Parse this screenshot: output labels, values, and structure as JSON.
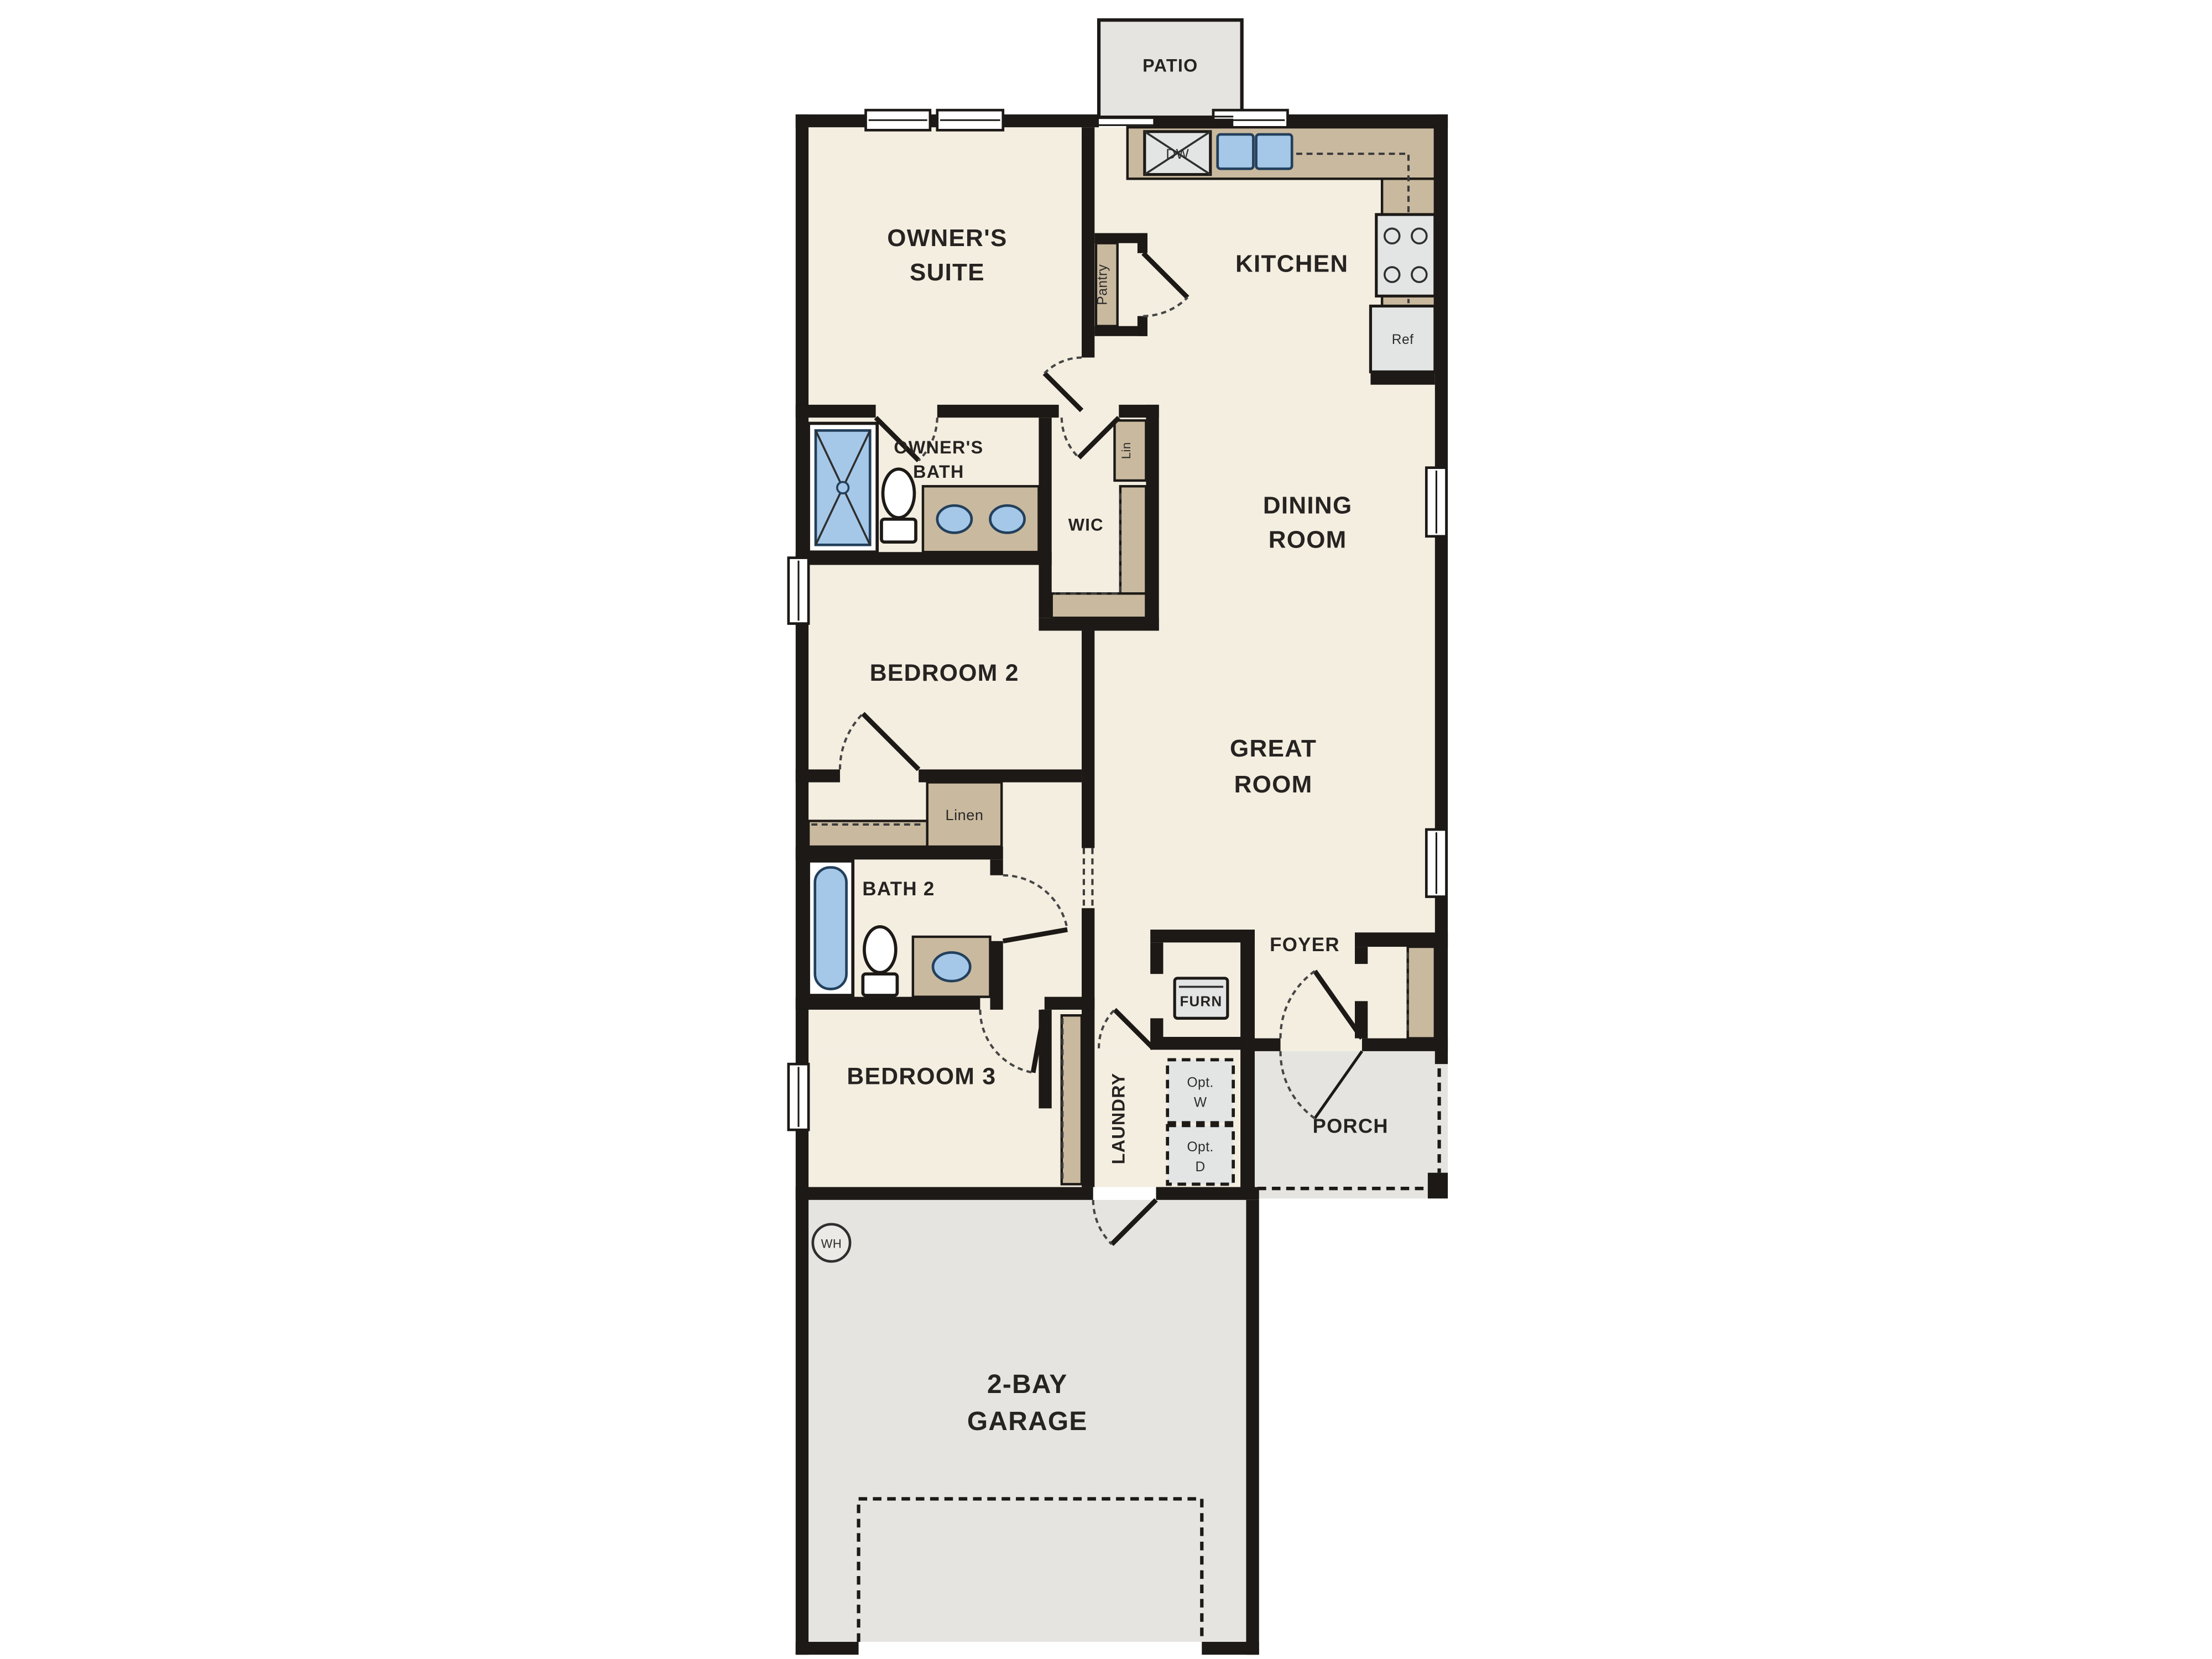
{
  "colors": {
    "wall": "#1c1916",
    "floor": "#f4eee1",
    "outdoor": "#e5e4e1",
    "counter": "#c9b99e",
    "fixture": "#a5c8e9",
    "appliance": "#e2e5e4",
    "text": "#262321",
    "dash": "#454545"
  },
  "plan": {
    "rooms": {
      "patio": {
        "label": "PATIO"
      },
      "owners_suite": {
        "lines": [
          "OWNER'S",
          "SUITE"
        ]
      },
      "kitchen": {
        "label": "KITCHEN"
      },
      "owners_bath": {
        "lines": [
          "OWNER'S",
          "BATH"
        ]
      },
      "wic": {
        "label": "WIC"
      },
      "dining_room": {
        "lines": [
          "DINING",
          "ROOM"
        ]
      },
      "bedroom2": {
        "label": "BEDROOM 2"
      },
      "great_room": {
        "lines": [
          "GREAT",
          "ROOM"
        ]
      },
      "bath2": {
        "label": "BATH 2"
      },
      "bedroom3": {
        "label": "BEDROOM 3"
      },
      "foyer": {
        "label": "FOYER"
      },
      "laundry": {
        "label": "LAUNDRY"
      },
      "porch": {
        "label": "PORCH"
      },
      "garage": {
        "lines": [
          "2-BAY",
          "GARAGE"
        ]
      }
    },
    "fixtures": {
      "dishwasher": "DW",
      "refrigerator": "Ref",
      "pantry": "Pantry",
      "linen_small": "Lin",
      "linen": "Linen",
      "furnace": "FURN",
      "opt_washer": [
        "Opt.",
        "W"
      ],
      "opt_dryer": [
        "Opt.",
        "D"
      ],
      "water_heater": "WH"
    }
  }
}
